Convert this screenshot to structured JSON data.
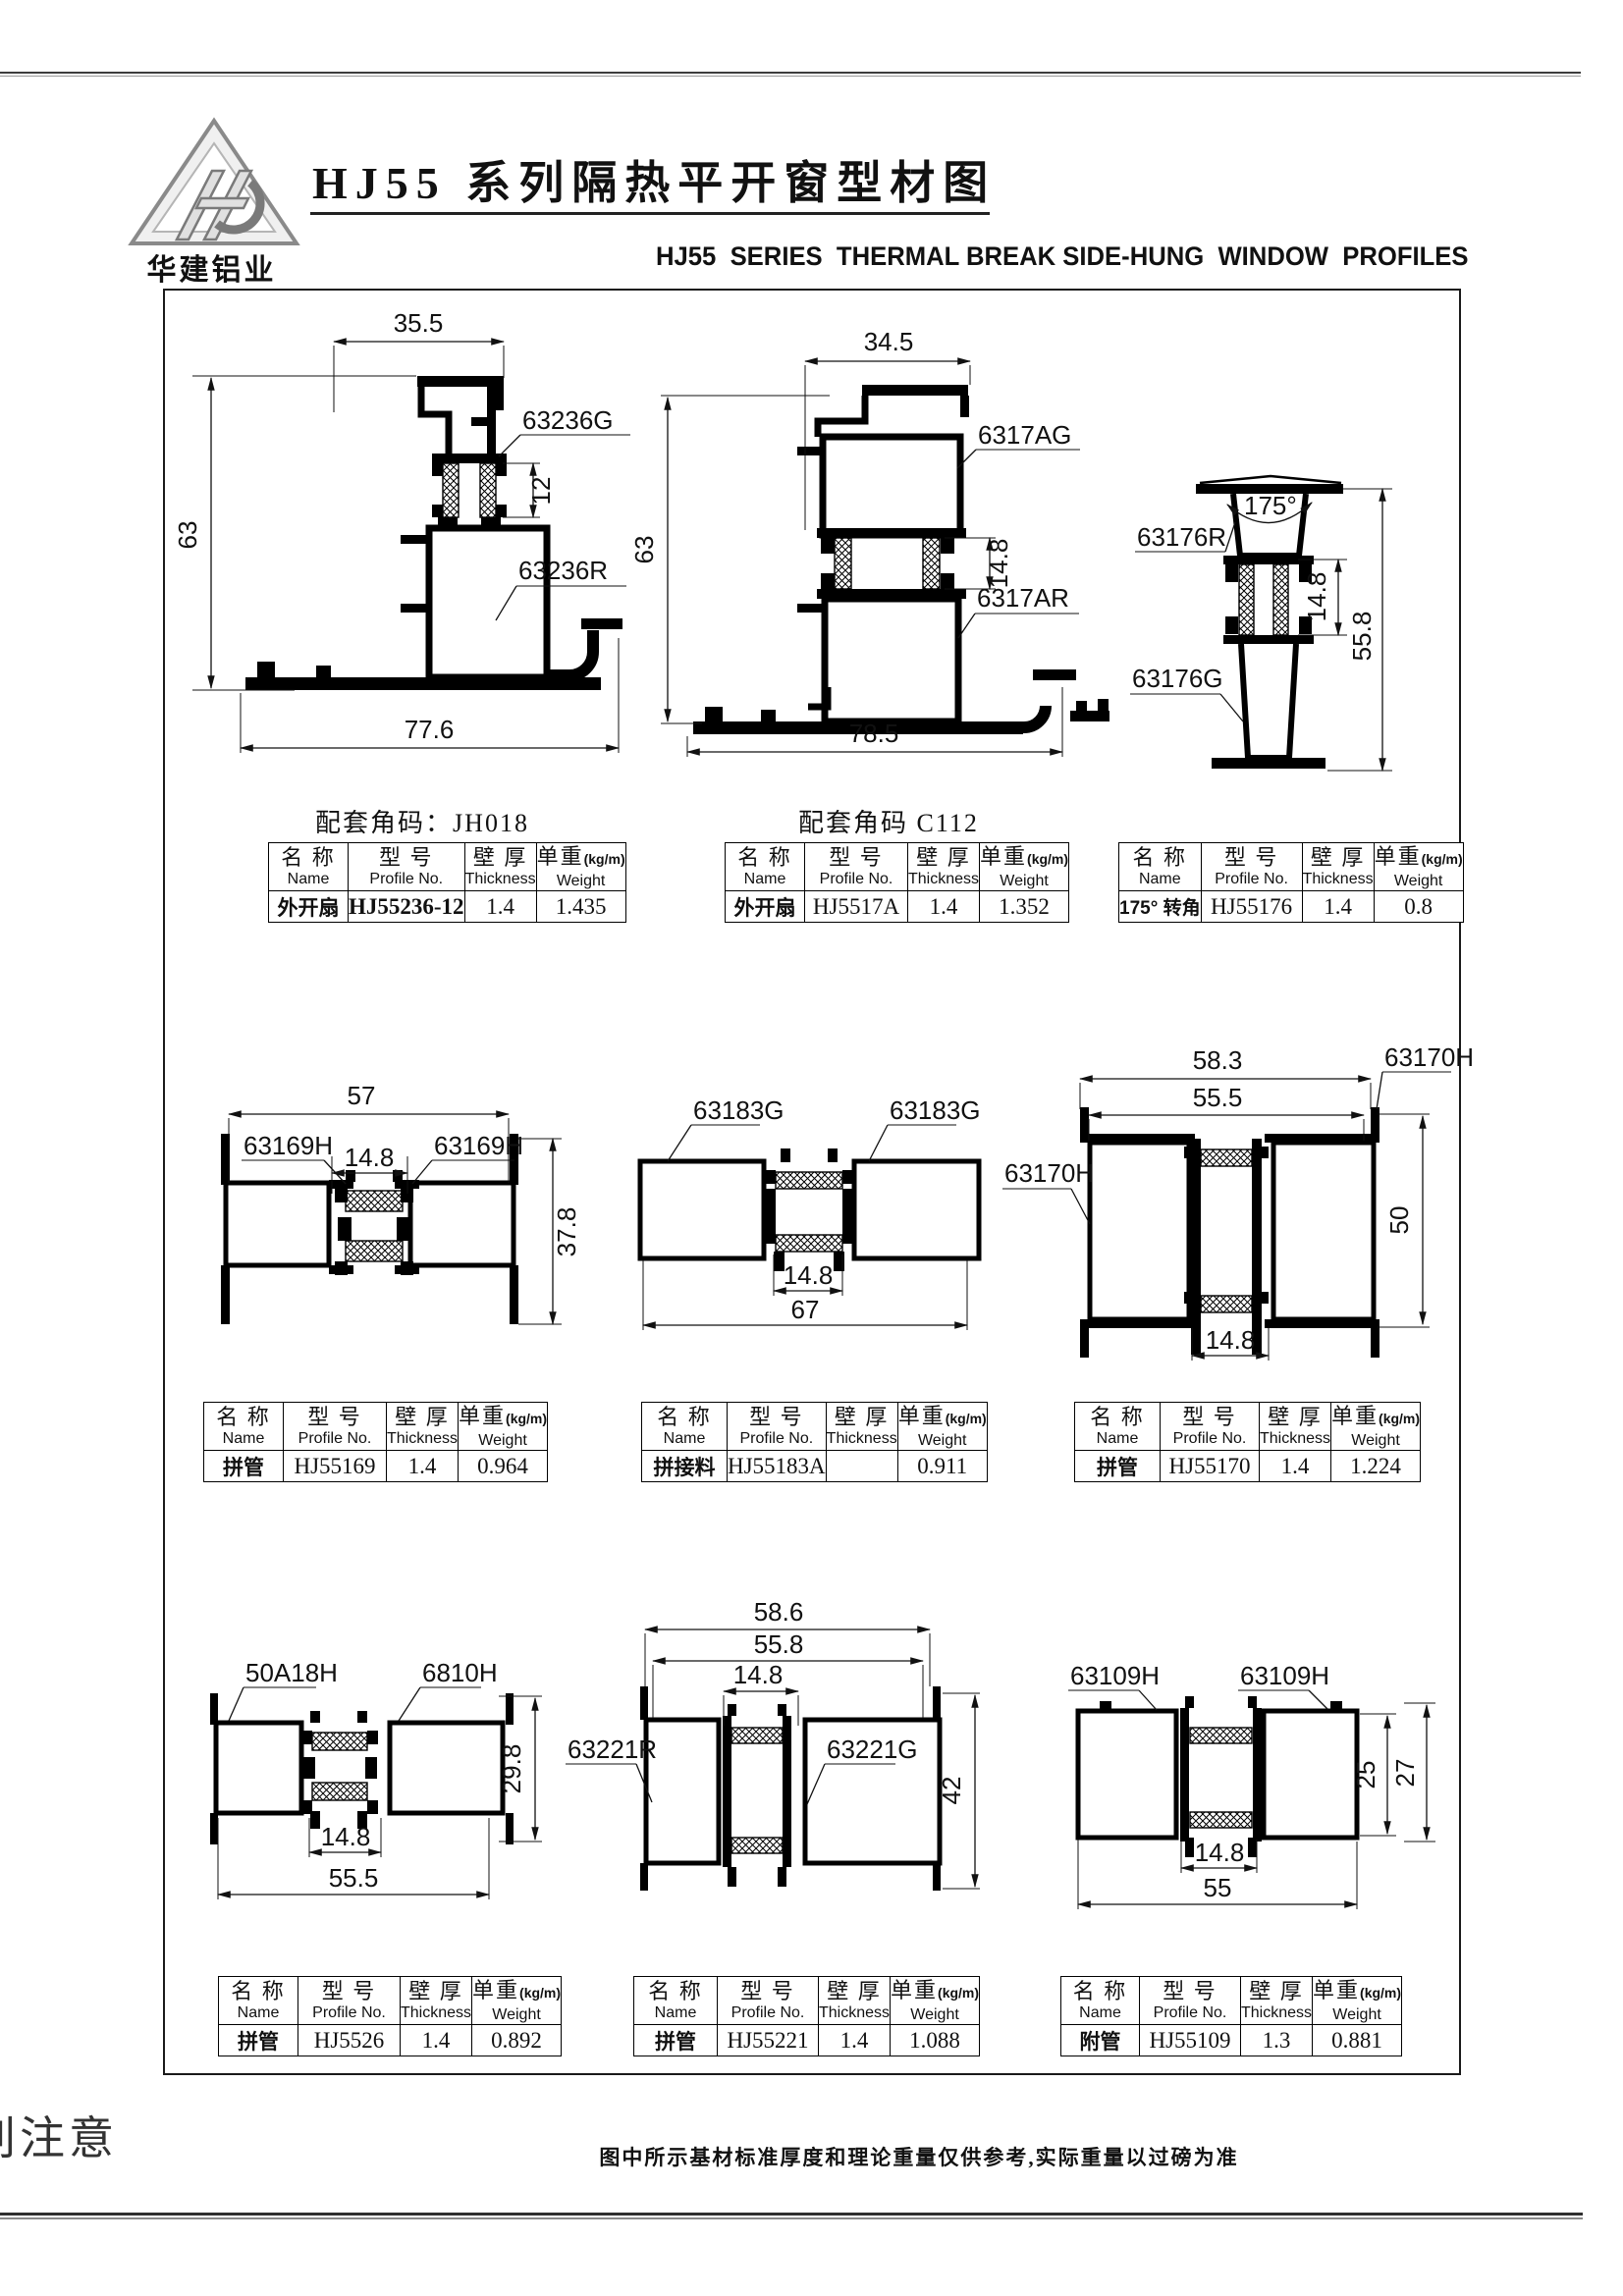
{
  "header": {
    "logo_text": "华建铝业",
    "title": "HJ55 系列隔热平开窗型材图",
    "subtitle": "HJ55  SERIES  THERMAL BREAK SIDE-HUNG  WINDOW  PROFILES"
  },
  "captions": {
    "jh018": "配套角码：JH018",
    "c112": "配套角码 C112"
  },
  "table_header": {
    "name_cn": "名 称",
    "name_en": "Name",
    "model_cn": "型 号",
    "model_en": "Profile No.",
    "thickness_cn": "壁 厚",
    "thickness_en": "Thickness",
    "weight_cn": "单重",
    "weight_unit": "(kg/m)",
    "weight_en": "Weight"
  },
  "tables": [
    {
      "name": "外开扇",
      "model": "HJ55236-12",
      "thickness": "1.4",
      "weight": "1.435"
    },
    {
      "name": "外开扇",
      "model": "HJ5517A",
      "thickness": "1.4",
      "weight": "1.352"
    },
    {
      "name": "175° 转角",
      "model": "HJ55176",
      "thickness": "1.4",
      "weight": "0.8"
    },
    {
      "name": "拼管",
      "model": "HJ55169",
      "thickness": "1.4",
      "weight": "0.964"
    },
    {
      "name": "拼接料",
      "model": "HJ55183A",
      "thickness": "",
      "weight": "0.911"
    },
    {
      "name": "拼管",
      "model": "HJ55170",
      "thickness": "1.4",
      "weight": "1.224"
    },
    {
      "name": "拼管",
      "model": "HJ5526",
      "thickness": "1.4",
      "weight": "0.892"
    },
    {
      "name": "拼管",
      "model": "HJ55221",
      "thickness": "1.4",
      "weight": "1.088"
    },
    {
      "name": "附管",
      "model": "HJ55109",
      "thickness": "1.3",
      "weight": "0.881"
    }
  ],
  "drawings": {
    "d1": {
      "dim_top": "35.5",
      "dim_left": "63",
      "dim_mid": "12",
      "dim_bottom": "77.6",
      "label_g": "63236G",
      "label_r": "63236R"
    },
    "d2": {
      "dim_top": "34.5",
      "dim_left": "63",
      "dim_mid": "14.8",
      "dim_bottom": "78.5",
      "label_g": "6317AG",
      "label_r": "6317AR"
    },
    "d3": {
      "angle": "175°",
      "dim_mid": "14.8",
      "dim_right": "55.8",
      "label_r": "63176R",
      "label_g": "63176G"
    },
    "d4": {
      "dim_top": "57",
      "dim_mid": "14.8",
      "dim_right": "37.8",
      "label_left": "63169H",
      "label_right": "63169H"
    },
    "d5": {
      "dim_mid": "14.8",
      "dim_bottom": "67",
      "label_left": "63183G",
      "label_right": "63183G",
      "label_next": "63170H"
    },
    "d6": {
      "dim_top1": "58.3",
      "dim_top2": "55.5",
      "dim_mid": "14.8",
      "dim_right": "50",
      "label_top": "63170H"
    },
    "d7": {
      "dim_right": "29.8",
      "dim_mid": "14.8",
      "dim_bottom": "55.5",
      "label_left": "50A18H",
      "label_right": "6810H"
    },
    "d8": {
      "dim_top1": "58.6",
      "dim_top2": "55.8",
      "dim_mid": "14.8",
      "dim_right": "42",
      "label_left": "63221R",
      "label_right": "63221G"
    },
    "d9": {
      "dim_right1": "25",
      "dim_right2": "27",
      "dim_mid": "14.8",
      "dim_bottom": "55",
      "label_left": "63109H",
      "label_right": "63109H"
    }
  },
  "footer": {
    "note": "图中所示基材标准厚度和理论重量仅供参考,实际重量以过磅为准",
    "side_text": "别注意"
  }
}
